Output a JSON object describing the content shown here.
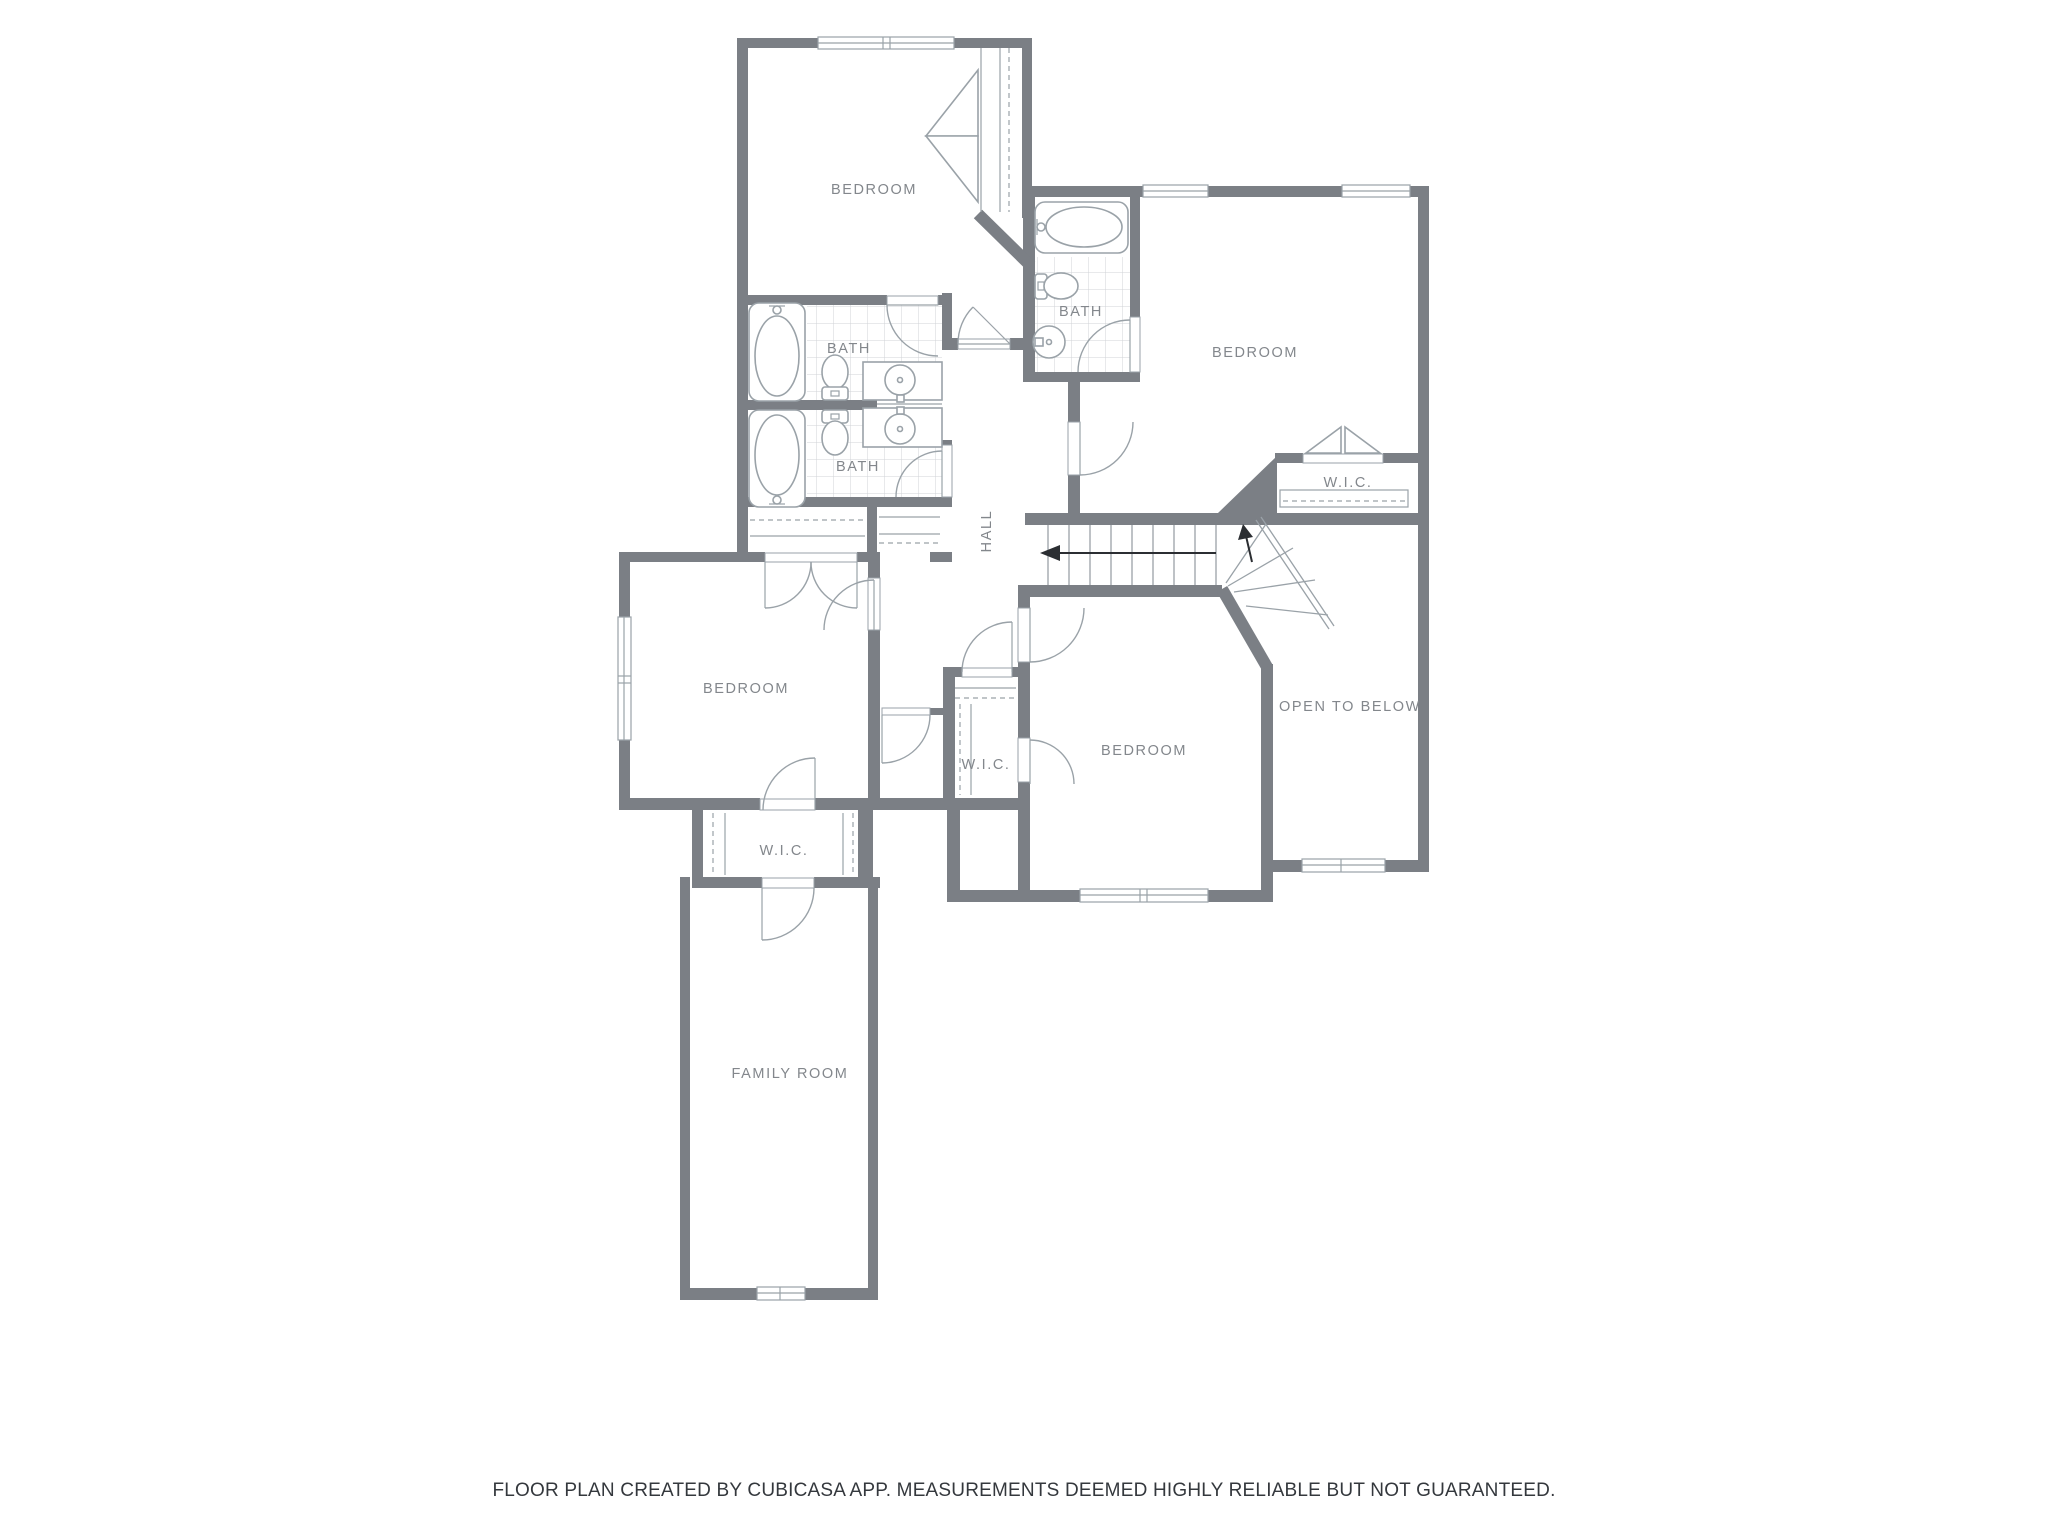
{
  "colors": {
    "background": "#ffffff",
    "wall": "#7b7f85",
    "fixture_stroke": "#9aa2a8",
    "tile_line": "#d0d3d7",
    "room_label": "#83878c",
    "footer_text": "#34383d",
    "arrow": "#2b2e32"
  },
  "floor_plan": {
    "rooms": [
      {
        "id": "bedroom-top-left",
        "label": "BEDROOM"
      },
      {
        "id": "bath-left-upper",
        "label": "BATH"
      },
      {
        "id": "bath-left-lower",
        "label": "BATH"
      },
      {
        "id": "bath-top-middle",
        "label": "BATH"
      },
      {
        "id": "bedroom-top-right",
        "label": "BEDROOM"
      },
      {
        "id": "wic-right",
        "label": "W.I.C."
      },
      {
        "id": "hall",
        "label": "HALL"
      },
      {
        "id": "open-to-below",
        "label": "OPEN TO BELOW"
      },
      {
        "id": "bedroom-left",
        "label": "BEDROOM"
      },
      {
        "id": "wic-center",
        "label": "W.I.C."
      },
      {
        "id": "bedroom-center",
        "label": "BEDROOM"
      },
      {
        "id": "wic-left",
        "label": "W.I.C."
      },
      {
        "id": "family-room",
        "label": "FAMILY ROOM"
      }
    ],
    "fixtures": {
      "bathtubs": 3,
      "toilets": 3,
      "sinks": 3,
      "staircases": 1,
      "closets": 5,
      "windows": 7
    },
    "footer": "FLOOR PLAN CREATED BY CUBICASA APP. MEASUREMENTS DEEMED HIGHLY RELIABLE BUT NOT GUARANTEED."
  }
}
